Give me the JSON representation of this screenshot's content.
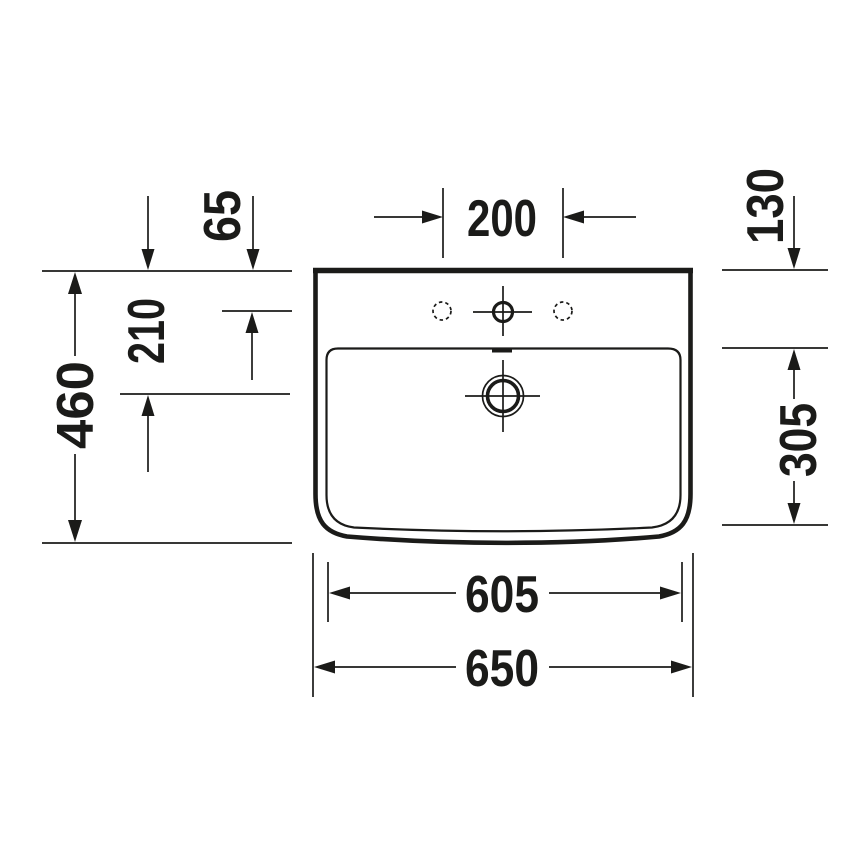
{
  "drawing": {
    "kind": "washbasin-top-view-technical-drawing",
    "colors": {
      "line": "#1b1b19",
      "background": "#ffffff"
    }
  },
  "dims": {
    "faucet_spacing": "200",
    "back_to_faucet_axis": "65",
    "back_to_bowl_back": "130",
    "back_to_drain_axis": "210",
    "bowl_depth": "305",
    "overall_depth": "460",
    "bowl_width": "605",
    "overall_width": "650"
  }
}
